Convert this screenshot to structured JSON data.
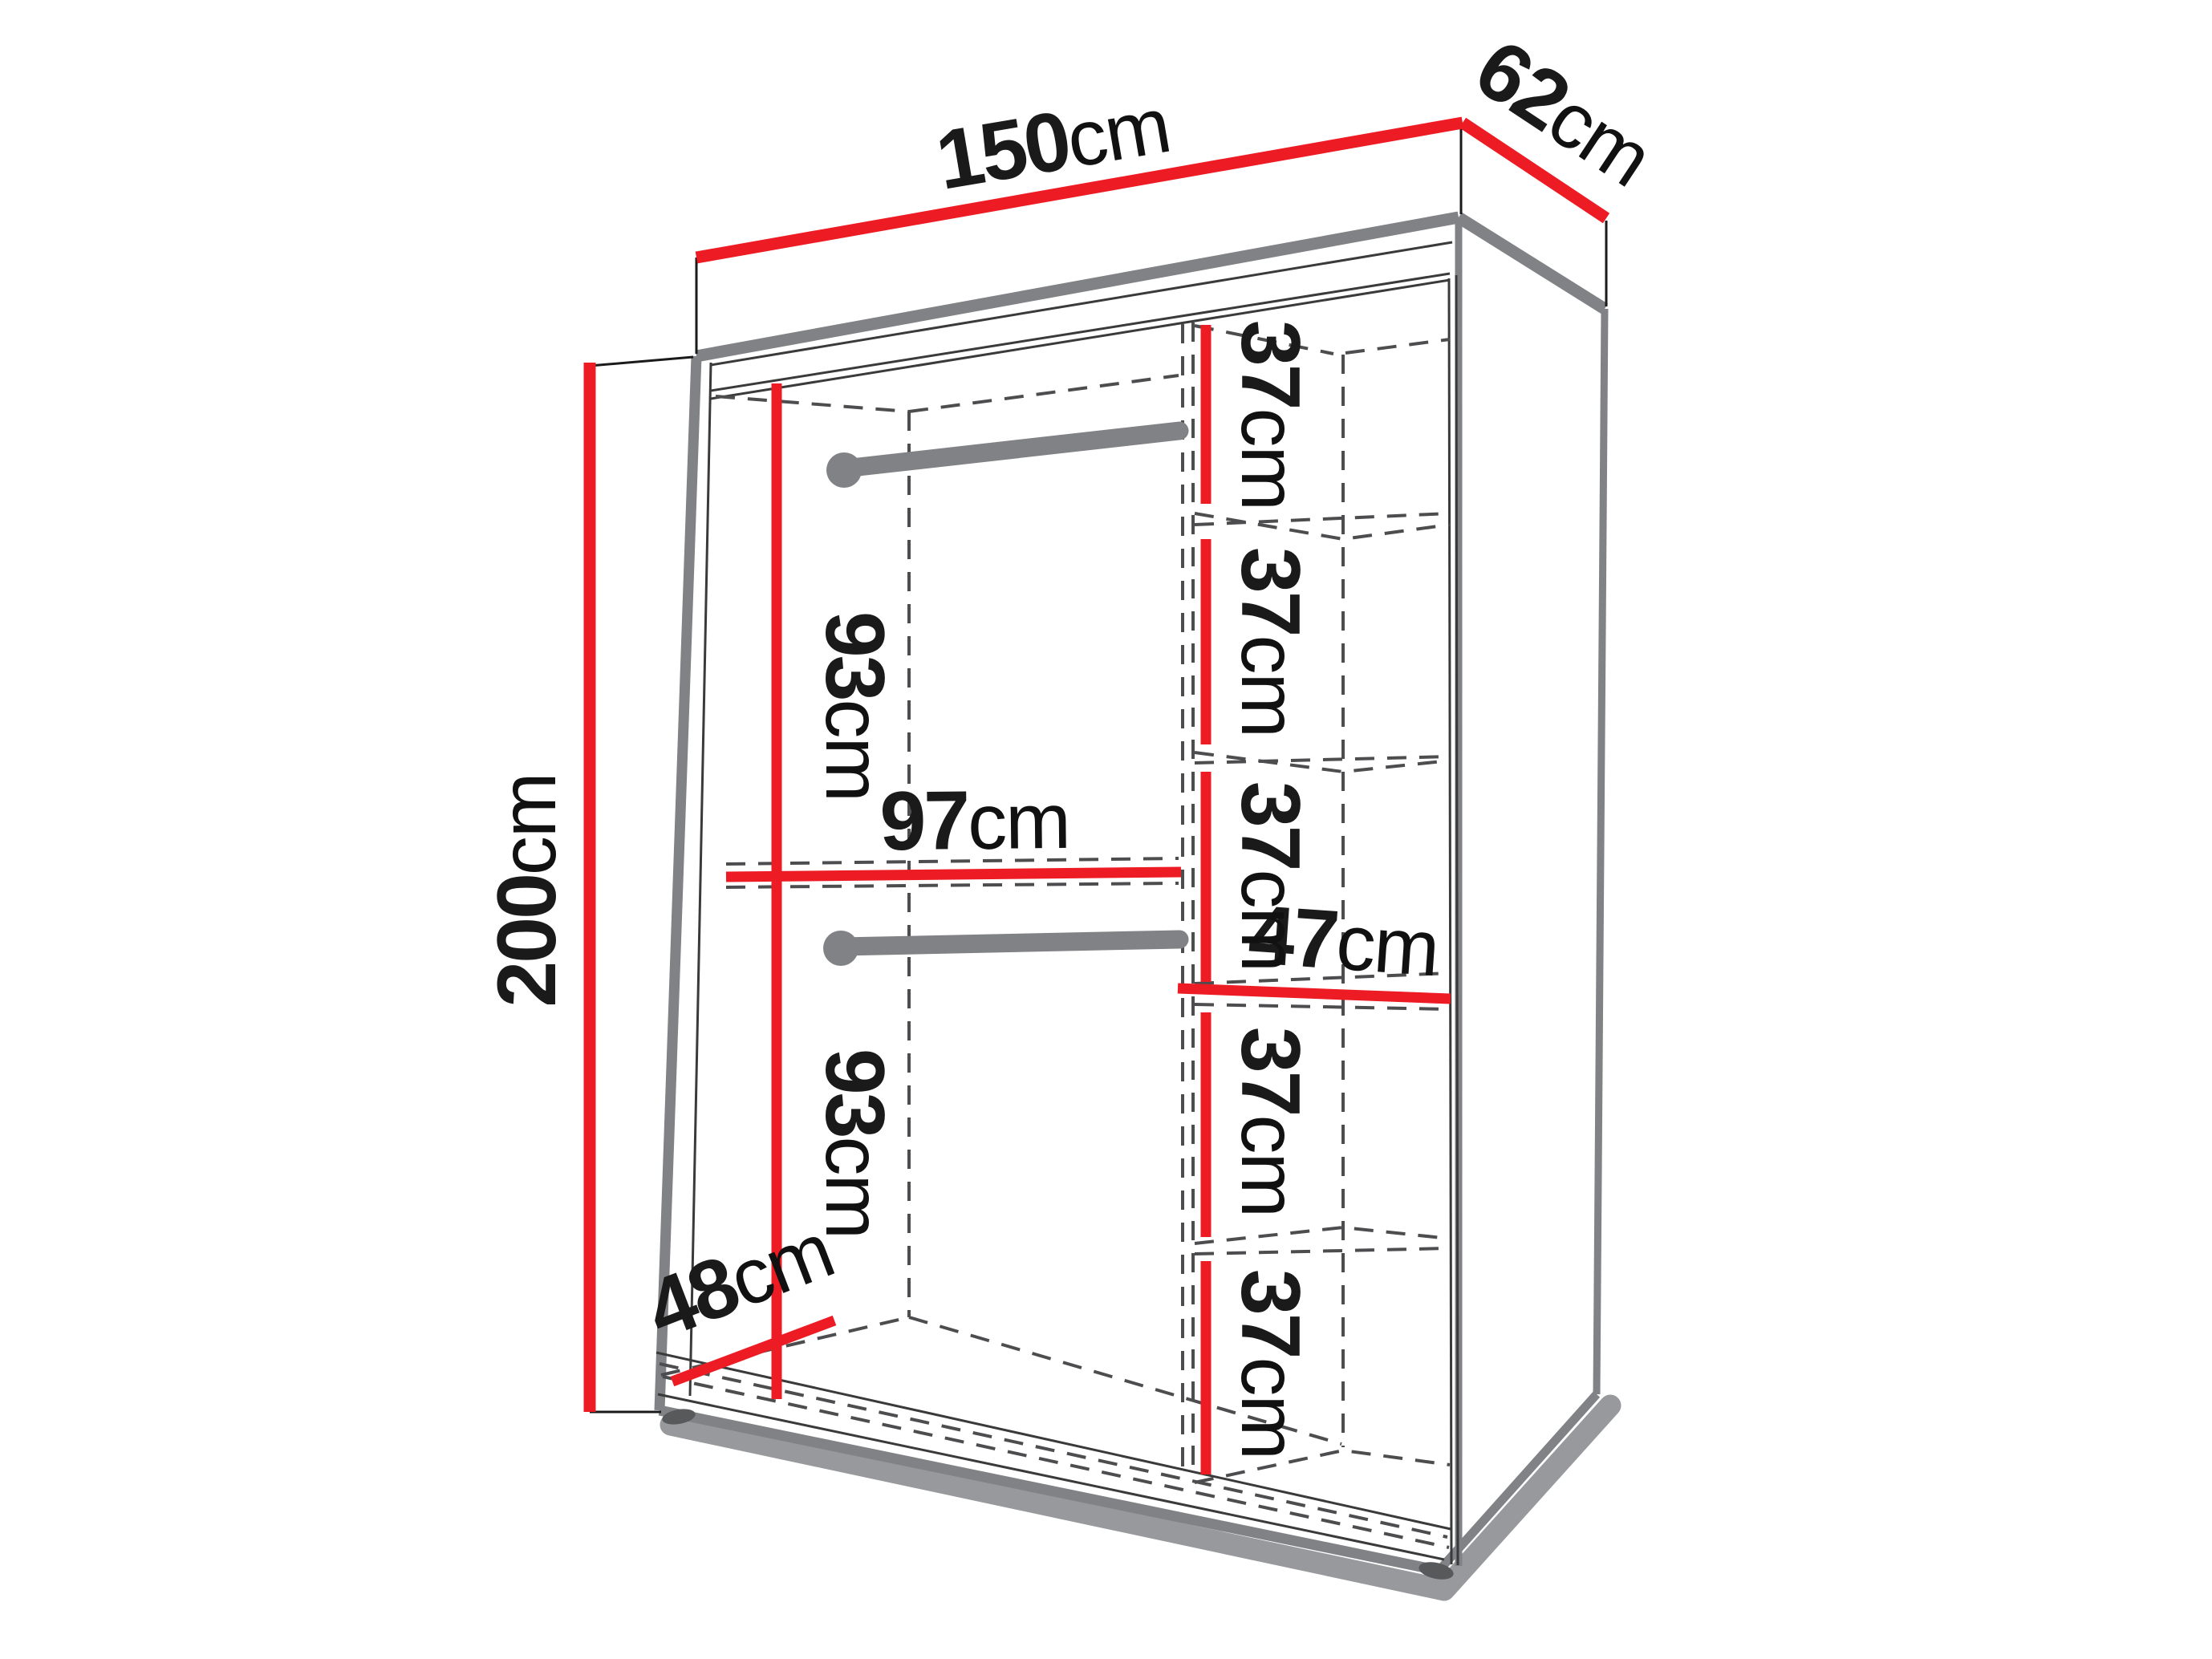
{
  "diagram": {
    "type": "wardrobe-dimension-diagram",
    "title": "Sliding wardrobe internal dimensions",
    "unit": "cm",
    "colors": {
      "dimension_accent": "#ed1c24",
      "outline_gray": "#808285",
      "hidden_line_gray": "#4d4d4f",
      "shadow_gray": "#97999c",
      "background": "#ffffff",
      "text_black": "#111111"
    },
    "measurements": {
      "overall_width_cm": 150,
      "overall_depth_cm": 62,
      "overall_height_cm": 200,
      "upper_hanging_section_height_cm": 93,
      "lower_hanging_section_height_cm": 93,
      "hanging_section_width_cm": 97,
      "interior_depth_cm": 48,
      "shelf_column_width_cm": 47,
      "shelf_spacings_cm": [
        37,
        37,
        37,
        37,
        37
      ],
      "hanging_rods": 2,
      "shelves": 5
    },
    "labels": {
      "width": {
        "value": "150",
        "unit": "cm"
      },
      "depth": {
        "value": "62",
        "unit": "cm"
      },
      "height": {
        "value": "200",
        "unit": "cm"
      },
      "upper_rail_height": {
        "value": "93",
        "unit": "cm"
      },
      "lower_rail_height": {
        "value": "93",
        "unit": "cm"
      },
      "rail_width": {
        "value": "97",
        "unit": "cm"
      },
      "interior_depth": {
        "value": "48",
        "unit": "cm"
      },
      "shelf_width": {
        "value": "47",
        "unit": "cm"
      },
      "shelf_gap_1": {
        "value": "37",
        "unit": "cm"
      },
      "shelf_gap_2": {
        "value": "37",
        "unit": "cm"
      },
      "shelf_gap_3": {
        "value": "37",
        "unit": "cm"
      },
      "shelf_gap_4": {
        "value": "37",
        "unit": "cm"
      },
      "shelf_gap_5": {
        "value": "37",
        "unit": "cm"
      }
    }
  }
}
